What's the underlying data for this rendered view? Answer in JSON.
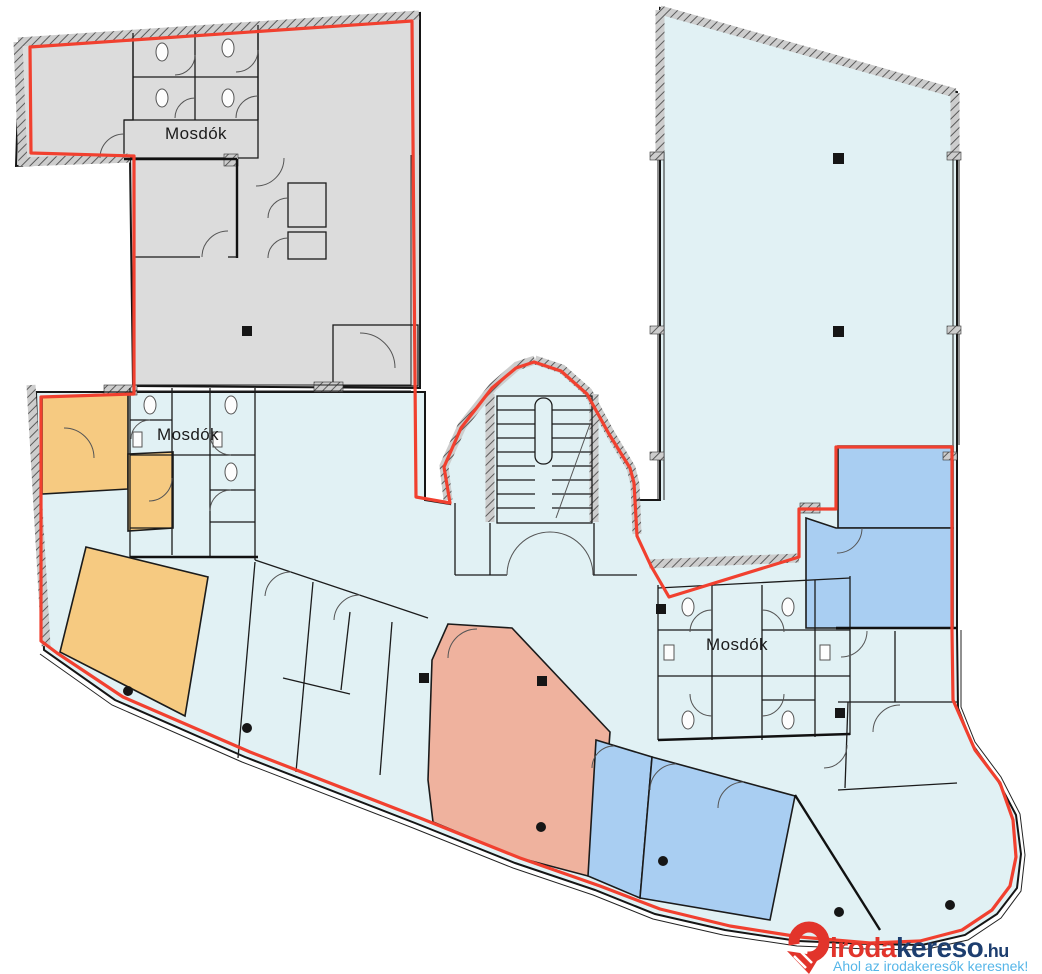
{
  "plan": {
    "restroom_labels": [
      {
        "id": "mosdok-top",
        "text": "Mosdók"
      },
      {
        "id": "mosdok-left",
        "text": "Mosdók"
      },
      {
        "id": "mosdok-right",
        "text": "Mosdók"
      }
    ]
  },
  "colors": {
    "floor": "#e1f1f4",
    "zone_gray": "#dcdcdc",
    "zone_orange": "#f6ca81",
    "zone_salmon": "#efb29e",
    "zone_blue": "#a9cef2",
    "outline_red": "#f1402f"
  },
  "logo": {
    "brand_primary": "iroda",
    "brand_secondary": "kereso",
    "tld": ".hu",
    "tagline": "Ahol az irodakeresők keresnek!",
    "color_primary": "#e2342b",
    "color_secondary": "#1d3e6f",
    "color_tagline": "#56b6e8"
  }
}
